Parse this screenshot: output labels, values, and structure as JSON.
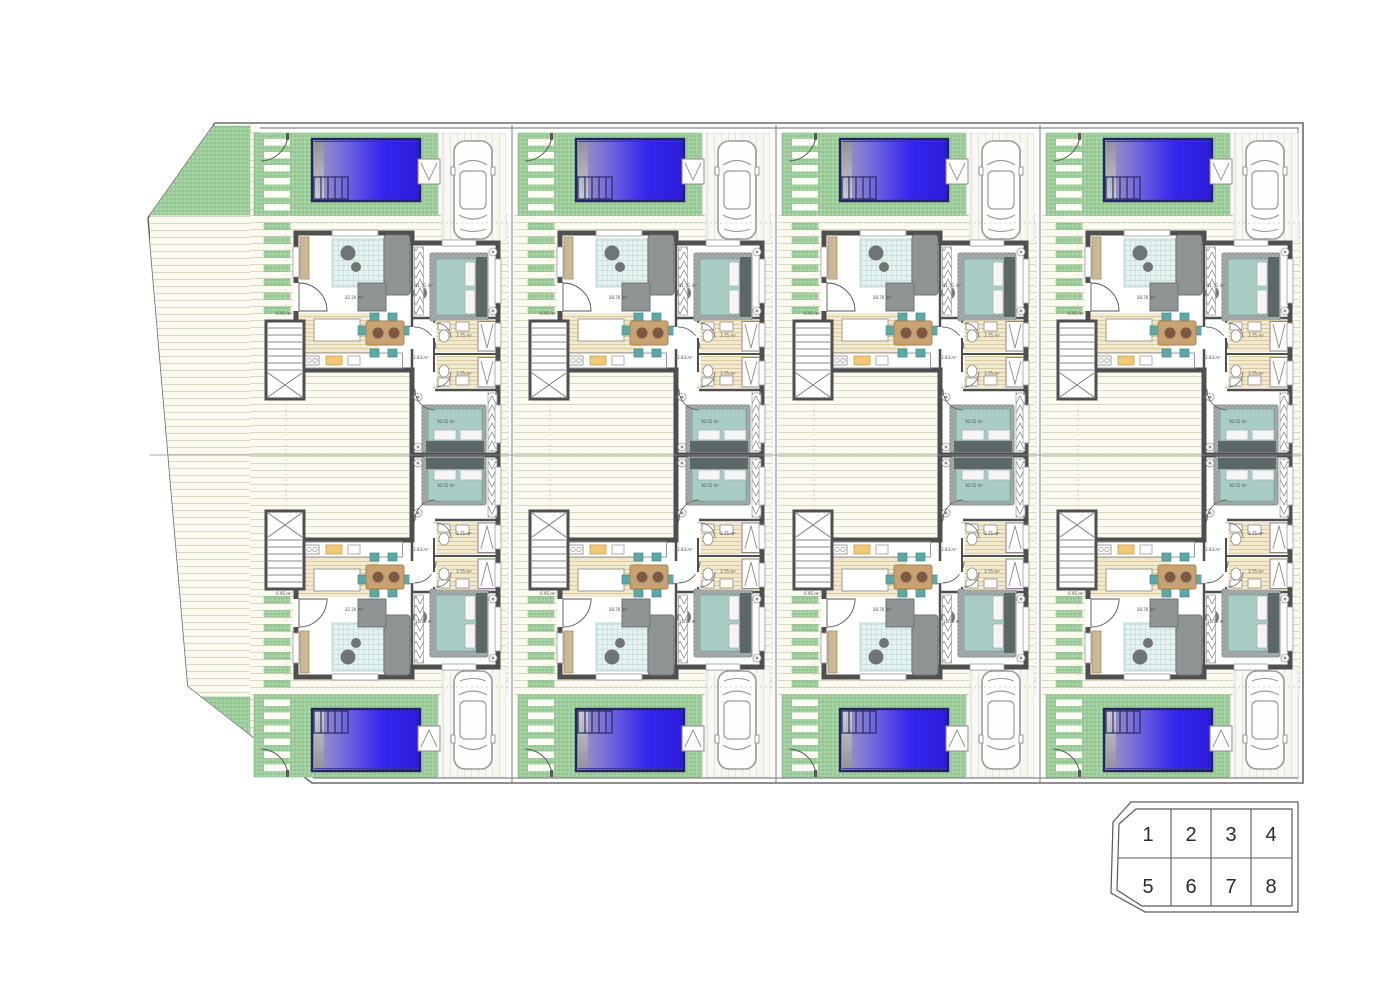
{
  "plan": {
    "title_hidden": "",
    "units": [
      {
        "id": "1",
        "col": 0,
        "row": "top",
        "labels": {
          "living": "32.20 m²",
          "bedroom1": "11.71 m²",
          "hall": "1.83 m²",
          "bath1": "3.75 m²",
          "bath2": "3.75 m²",
          "bedroom2": "10.51 m²",
          "porch": "6.95 m²"
        }
      },
      {
        "id": "2",
        "col": 1,
        "row": "top",
        "labels": {
          "living": "28.76 m²",
          "bedroom1": "11.71 m²",
          "hall": "1.83 m²",
          "bath1": "3.75 m²",
          "bath2": "3.75 m²",
          "bedroom2": "10.51 m²",
          "porch": "6.95 m²"
        }
      },
      {
        "id": "3",
        "col": 2,
        "row": "top",
        "labels": {
          "living": "28.76 m²",
          "bedroom1": "11.71 m²",
          "hall": "1.83 m²",
          "bath1": "3.75 m²",
          "bath2": "3.75 m²",
          "bedroom2": "10.51 m²",
          "porch": "6.95 m²"
        }
      },
      {
        "id": "4",
        "col": 3,
        "row": "top",
        "labels": {
          "living": "28.76 m²",
          "bedroom1": "11.71 m²",
          "hall": "1.83 m²",
          "bath1": "3.75 m²",
          "bath2": "3.75 m²",
          "bedroom2": "10.51 m²",
          "porch": "6.95 m²"
        }
      },
      {
        "id": "5",
        "col": 0,
        "row": "bottom",
        "labels": {
          "living": "32.20 m²",
          "bedroom1": "11.71 m²",
          "hall": "1.83 m²",
          "bath1": "3.75 m²",
          "bath2": "3.75 m²",
          "bedroom2": "10.51 m²",
          "porch": "6.95 m²"
        }
      },
      {
        "id": "6",
        "col": 1,
        "row": "bottom",
        "labels": {
          "living": "28.76 m²",
          "bedroom1": "11.71 m²",
          "hall": "1.83 m²",
          "bath1": "3.75 m²",
          "bath2": "3.75 m²",
          "bedroom2": "10.51 m²",
          "porch": "6.95 m²"
        }
      },
      {
        "id": "7",
        "col": 2,
        "row": "bottom",
        "labels": {
          "living": "28.76 m²",
          "bedroom1": "11.71 m²",
          "hall": "1.83 m²",
          "bath1": "3.75 m²",
          "bath2": "3.75 m²",
          "bedroom2": "10.51 m²",
          "porch": "6.95 m²"
        }
      },
      {
        "id": "8",
        "col": 3,
        "row": "bottom",
        "labels": {
          "living": "28.76 m²",
          "bedroom1": "11.71 m²",
          "hall": "1.83 m²",
          "bath1": "3.75 m²",
          "bath2": "3.75 m²",
          "bedroom2": "10.51 m²",
          "porch": "6.95 m²"
        }
      }
    ]
  },
  "key_plan": {
    "units": [
      "1",
      "2",
      "3",
      "4",
      "5",
      "6",
      "7",
      "8"
    ]
  },
  "colors": {
    "pool_blue": "#2a1ce0",
    "pool_border": "#23235e",
    "lawn_green": "#9ccd9a",
    "deck_cream": "#fbfaf1",
    "wall_gray": "#4f4f4f",
    "bed_teal": "#a9ccc5",
    "sofa_gray": "#8f9494",
    "table_tan": "#c9a271",
    "chair_teal": "#5fa8a8",
    "bath_beige": "#f2ead0"
  }
}
